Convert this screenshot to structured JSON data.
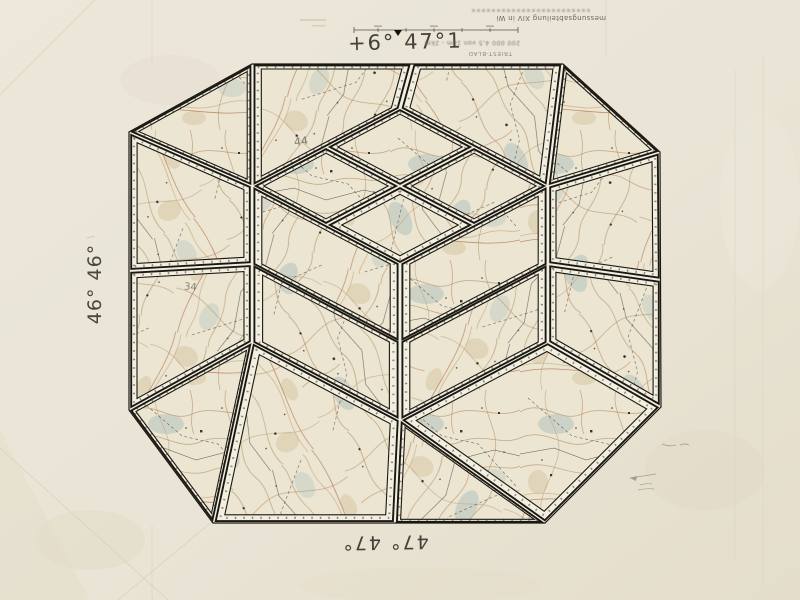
{
  "photo": {
    "annotations": {
      "top": "+6° 47°1",
      "left": "46° 46°",
      "bottom": "47° 47°",
      "pencil_top": "44",
      "pencil_left": "34"
    },
    "caption": {
      "department_line": "messungsabteilung XIV in Wi",
      "scale_line": "200 000  4,5 von 1cm - 2km",
      "sheet_label": "TRIEST-BLAD"
    },
    "colors": {
      "paper": "#e9e4d5",
      "backing": "#f0eee0",
      "line": "#1b1812",
      "sheet_margin": "#f2efe1",
      "map_base": "#ebe5d2",
      "contour": "#c2a47c",
      "water": "#b4c2bd",
      "road_red": "#b97f5a",
      "ink": "#45413a",
      "pencil": "#6e685c"
    },
    "collage": {
      "outline": [
        [
          252,
          64
        ],
        [
          563,
          64
        ],
        [
          660,
          152
        ],
        [
          661,
          407
        ],
        [
          545,
          523
        ],
        [
          213,
          523
        ],
        [
          129,
          410
        ],
        [
          129,
          132
        ]
      ],
      "pieces": [
        {
          "points": [
            [
              129,
              132
            ],
            [
              252,
              64
            ],
            [
              252,
              186
            ]
          ],
          "inset": 9
        },
        {
          "points": [
            [
              252,
              64
            ],
            [
              412,
              64
            ],
            [
              400,
              108
            ],
            [
              252,
              186
            ]
          ],
          "inset": 11
        },
        {
          "points": [
            [
              412,
              64
            ],
            [
              563,
              64
            ],
            [
              548,
              186
            ],
            [
              400,
              108
            ]
          ],
          "inset": 11
        },
        {
          "points": [
            [
              563,
              64
            ],
            [
              660,
              152
            ],
            [
              548,
              186
            ]
          ],
          "inset": 9
        },
        {
          "points": [
            [
              660,
              152
            ],
            [
              661,
              280
            ],
            [
              548,
              264
            ],
            [
              548,
              186
            ]
          ],
          "inset": 11
        },
        {
          "points": [
            [
              661,
              280
            ],
            [
              661,
              407
            ],
            [
              548,
              342
            ],
            [
              548,
              264
            ]
          ],
          "inset": 11
        },
        {
          "points": [
            [
              661,
              407
            ],
            [
              545,
              523
            ],
            [
              400,
              420
            ],
            [
              548,
              342
            ]
          ],
          "inset": 13
        },
        {
          "points": [
            [
              545,
              523
            ],
            [
              395,
              523
            ],
            [
              400,
              420
            ]
          ],
          "inset": 9
        },
        {
          "points": [
            [
              395,
              523
            ],
            [
              213,
              523
            ],
            [
              252,
              342
            ],
            [
              400,
              420
            ]
          ],
          "inset": 13
        },
        {
          "points": [
            [
              213,
              523
            ],
            [
              129,
              410
            ],
            [
              252,
              342
            ]
          ],
          "inset": 9
        },
        {
          "points": [
            [
              129,
              410
            ],
            [
              129,
              271
            ],
            [
              252,
              264
            ],
            [
              252,
              342
            ]
          ],
          "inset": 11
        },
        {
          "points": [
            [
              129,
              271
            ],
            [
              129,
              132
            ],
            [
              252,
              186
            ],
            [
              252,
              264
            ]
          ],
          "inset": 11
        },
        {
          "points": [
            [
              400,
              108
            ],
            [
              474,
              147
            ],
            [
              400,
              186
            ],
            [
              326,
              147
            ]
          ],
          "inset": 9
        },
        {
          "points": [
            [
              474,
              147
            ],
            [
              548,
              186
            ],
            [
              474,
              225
            ],
            [
              400,
              186
            ]
          ],
          "inset": 9
        },
        {
          "points": [
            [
              400,
              186
            ],
            [
              474,
              225
            ],
            [
              400,
              264
            ],
            [
              326,
              225
            ]
          ],
          "inset": 12
        },
        {
          "points": [
            [
              326,
              147
            ],
            [
              400,
              186
            ],
            [
              326,
              225
            ],
            [
              252,
              186
            ]
          ],
          "inset": 9
        },
        {
          "points": [
            [
              252,
              186
            ],
            [
              400,
              264
            ],
            [
              400,
              342
            ],
            [
              252,
              264
            ]
          ],
          "inset": 12
        },
        {
          "points": [
            [
              252,
              264
            ],
            [
              400,
              342
            ],
            [
              400,
              420
            ],
            [
              252,
              342
            ]
          ],
          "inset": 13
        },
        {
          "points": [
            [
              400,
              264
            ],
            [
              548,
              186
            ],
            [
              548,
              264
            ],
            [
              400,
              342
            ]
          ],
          "inset": 12
        },
        {
          "points": [
            [
              400,
              342
            ],
            [
              548,
              264
            ],
            [
              548,
              342
            ],
            [
              400,
              420
            ]
          ],
          "inset": 12
        }
      ]
    }
  }
}
